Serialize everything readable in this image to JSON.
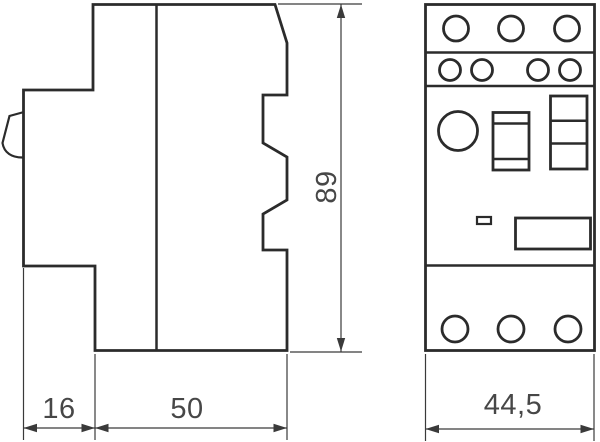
{
  "colors": {
    "outline": "#2b2b2b",
    "dimension": "#3a3a3a",
    "text": "#474747",
    "background": "#ffffff"
  },
  "dimensions": {
    "clip_depth": {
      "label": "16"
    },
    "body_depth": {
      "label": "50"
    },
    "height": {
      "label": "89"
    },
    "width": {
      "label": "44,5"
    }
  }
}
